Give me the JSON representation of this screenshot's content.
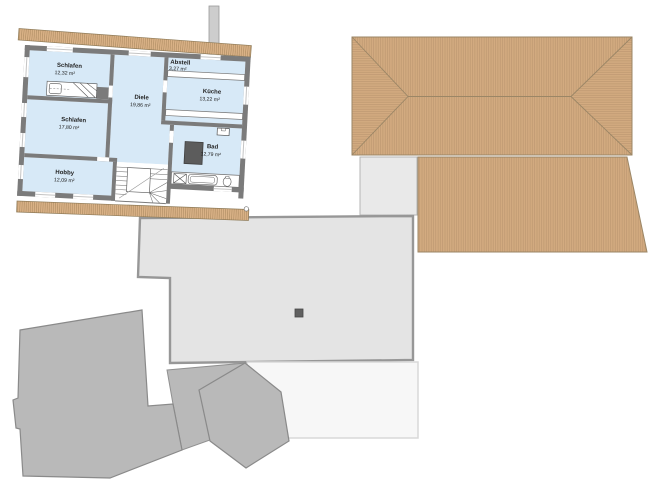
{
  "page": {
    "background": "#ffffff"
  },
  "plan": {
    "rooms": [
      {
        "id": "schlafen-1",
        "name": "Schlafen",
        "area": "12,32 m²"
      },
      {
        "id": "schlafen-2",
        "name": "Schlafen",
        "area": "17,80 m²"
      },
      {
        "id": "hobby",
        "name": "Hobby",
        "area": "12,09 m²"
      },
      {
        "id": "diele",
        "name": "Diele",
        "area": "19,86 m²"
      },
      {
        "id": "abstell",
        "name": "Abstell",
        "area": "3,27 m²"
      },
      {
        "id": "kueche",
        "name": "Küche",
        "area": "13,22 m²"
      },
      {
        "id": "bad",
        "name": "Bad",
        "area": "12,79 m²"
      }
    ],
    "colors": {
      "room_fill": "#d7e9f7",
      "wall": "#7b7b7b",
      "fixture_dark": "#5c5c5c",
      "roof_fill": "#d3ab80",
      "roof_hatch": "#bc9670",
      "roof_edge": "#9b8666",
      "eaves_fill": "#dab287",
      "flat_roof_fill": "#e4e4e4",
      "flat_roof_edge": "#979797",
      "upper_band_fill": "#e9e9e9",
      "building_fill": "#b9b9b9",
      "building_edge": "#8a8a8a",
      "light_area_fill": "#f7f7f7",
      "chimney_fill": "#cdcdcd"
    }
  }
}
